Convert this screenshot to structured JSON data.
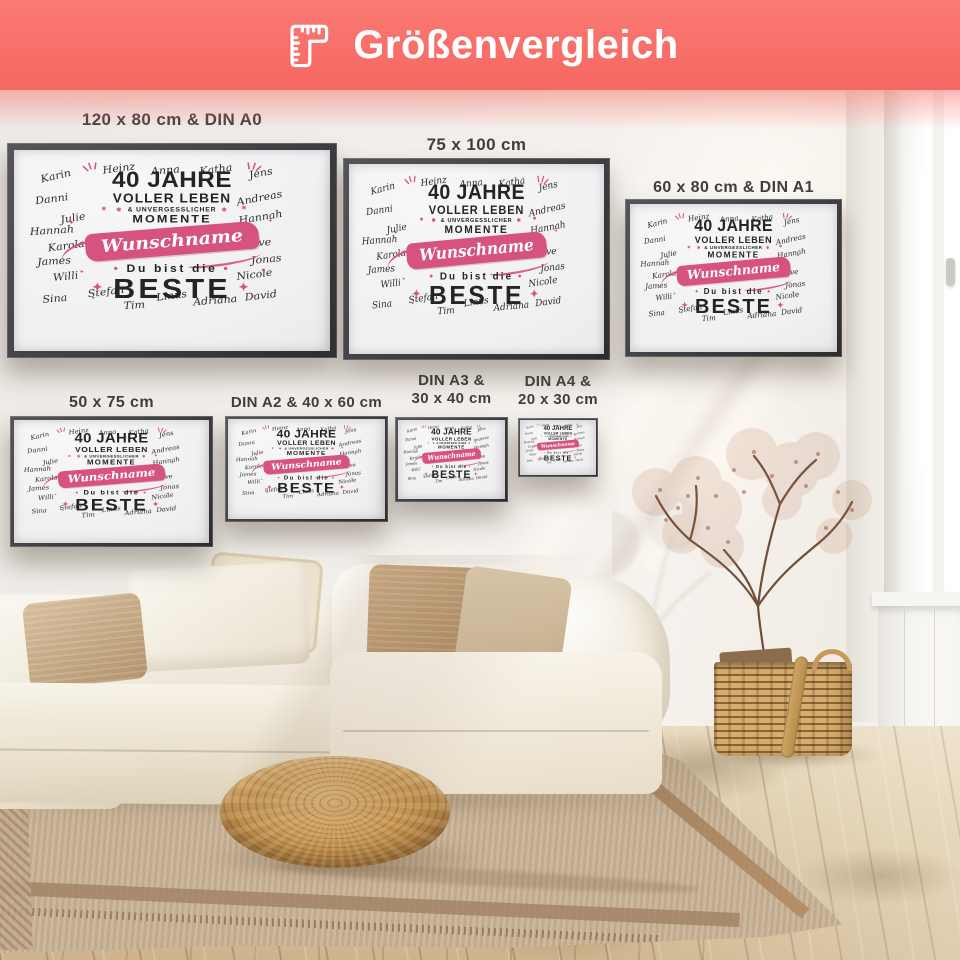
{
  "header": {
    "title": "Größenvergleich",
    "icon": "ruler-icon",
    "bg_color": "#f8716d",
    "text_color": "#ffffff"
  },
  "design": {
    "pink": "#d5537d",
    "ink": "#242424",
    "line1": "40 JAHRE",
    "line2": "VOLLER LEBEN",
    "line3": "& UNVERGESSLICHER",
    "line4": "MOMENTE",
    "ribbon": "Wunschname",
    "line5": "Du bist die",
    "line6": "BESTE",
    "names": [
      {
        "text": "Karin",
        "x": 50,
        "y": 42,
        "r": -14
      },
      {
        "text": "Heinz",
        "x": 168,
        "y": 26,
        "r": -8
      },
      {
        "text": "Anna",
        "x": 260,
        "y": 30,
        "r": -5
      },
      {
        "text": "Katha",
        "x": 352,
        "y": 28,
        "r": -8
      },
      {
        "text": "Jens",
        "x": 446,
        "y": 36,
        "r": -12
      },
      {
        "text": "Danni",
        "x": 40,
        "y": 90,
        "r": -8
      },
      {
        "text": "Andreas",
        "x": 422,
        "y": 88,
        "r": -12
      },
      {
        "text": "Julie",
        "x": 88,
        "y": 130,
        "r": -10
      },
      {
        "text": "Hannah",
        "x": 426,
        "y": 128,
        "r": -10
      },
      {
        "text": "Hannah",
        "x": 30,
        "y": 156,
        "r": -4
      },
      {
        "text": "Karola",
        "x": 64,
        "y": 188,
        "r": -8
      },
      {
        "text": "Merve",
        "x": 420,
        "y": 182,
        "r": -4
      },
      {
        "text": "James",
        "x": 44,
        "y": 220,
        "r": -4
      },
      {
        "text": "Jonas",
        "x": 450,
        "y": 216,
        "r": -6
      },
      {
        "text": "Willi",
        "x": 74,
        "y": 252,
        "r": -6
      },
      {
        "text": "Nicole",
        "x": 422,
        "y": 248,
        "r": -8
      },
      {
        "text": "Sina",
        "x": 54,
        "y": 298,
        "r": -6
      },
      {
        "text": "Stefan",
        "x": 140,
        "y": 284,
        "r": -8
      },
      {
        "text": "Tim",
        "x": 208,
        "y": 312,
        "r": -4
      },
      {
        "text": "Linus",
        "x": 270,
        "y": 292,
        "r": -8
      },
      {
        "text": "Adriana",
        "x": 340,
        "y": 302,
        "r": -5
      },
      {
        "text": "David",
        "x": 438,
        "y": 292,
        "r": -7
      }
    ]
  },
  "posters": [
    {
      "name": "poster-120x80-din-a0",
      "label_lines": [
        "120 x 80 cm & DIN A0"
      ],
      "x": 7,
      "y": 143,
      "w": 330,
      "h": 215,
      "label_top": 110,
      "label_size": 17
    },
    {
      "name": "poster-75x100",
      "label_lines": [
        "75 x 100 cm"
      ],
      "x": 343,
      "y": 158,
      "w": 267,
      "h": 202,
      "label_top": 135,
      "label_size": 17
    },
    {
      "name": "poster-60x80-din-a1",
      "label_lines": [
        "60 x 80 cm & DIN A1"
      ],
      "x": 625,
      "y": 199,
      "w": 217,
      "h": 158,
      "label_top": 178,
      "label_size": 16
    },
    {
      "name": "poster-50x75",
      "label_lines": [
        "50 x 75 cm"
      ],
      "x": 10,
      "y": 416,
      "w": 203,
      "h": 131,
      "label_top": 393,
      "label_size": 16
    },
    {
      "name": "poster-din-a2-40x60",
      "label_lines": [
        "DIN A2 & 40 x 60 cm"
      ],
      "x": 225,
      "y": 416,
      "w": 163,
      "h": 106,
      "label_top": 394,
      "label_size": 15
    },
    {
      "name": "poster-din-a3-30x40",
      "label_lines": [
        "DIN A3 &",
        "30 x 40 cm"
      ],
      "x": 395,
      "y": 417,
      "w": 113,
      "h": 85,
      "label_top": 372,
      "label_size": 15
    },
    {
      "name": "poster-din-a4-20x30",
      "label_lines": [
        "DIN A4 &",
        "20 x 30 cm"
      ],
      "x": 518,
      "y": 418,
      "w": 80,
      "h": 59,
      "label_top": 373,
      "label_size": 15
    }
  ]
}
